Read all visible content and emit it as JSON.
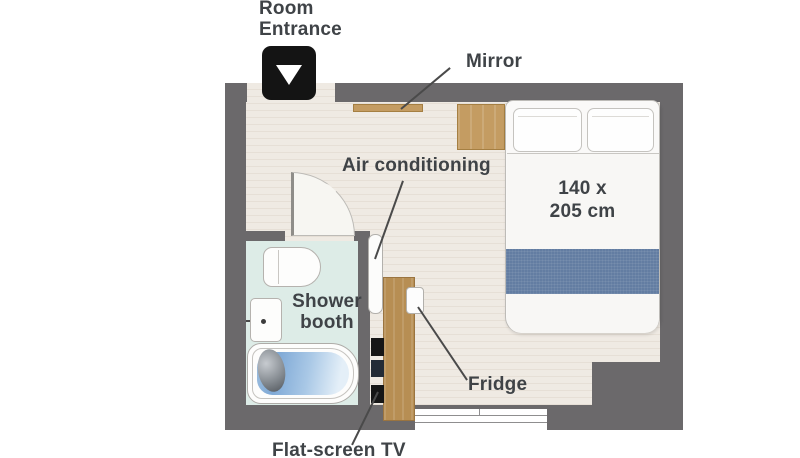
{
  "colors": {
    "wall": "#6b696b",
    "floor": "#efeae3",
    "floor_stripe": "#e6dfd6",
    "bathroom_floor": "#ddece7",
    "wood": "#c49c62",
    "cabinet_wood": "#b78e53",
    "runner_blue": "#637da2",
    "water_blue": "#7fa9d6",
    "tv_black": "#161616",
    "entrance_black": "#141414",
    "label_text": "#3f4347",
    "leader": "#4a4a4a"
  },
  "labels": {
    "entrance_line1": "Room",
    "entrance_line2": "Entrance",
    "mirror": "Mirror",
    "air_conditioning": "Air conditioning",
    "bed_size_line1": "140 x",
    "bed_size_line2": "205 cm",
    "shower_line1": "Shower",
    "shower_line2": "booth",
    "fridge": "Fridge",
    "tv": "Flat-screen TV"
  },
  "icons": {
    "entrance_arrow": "down-triangle"
  }
}
